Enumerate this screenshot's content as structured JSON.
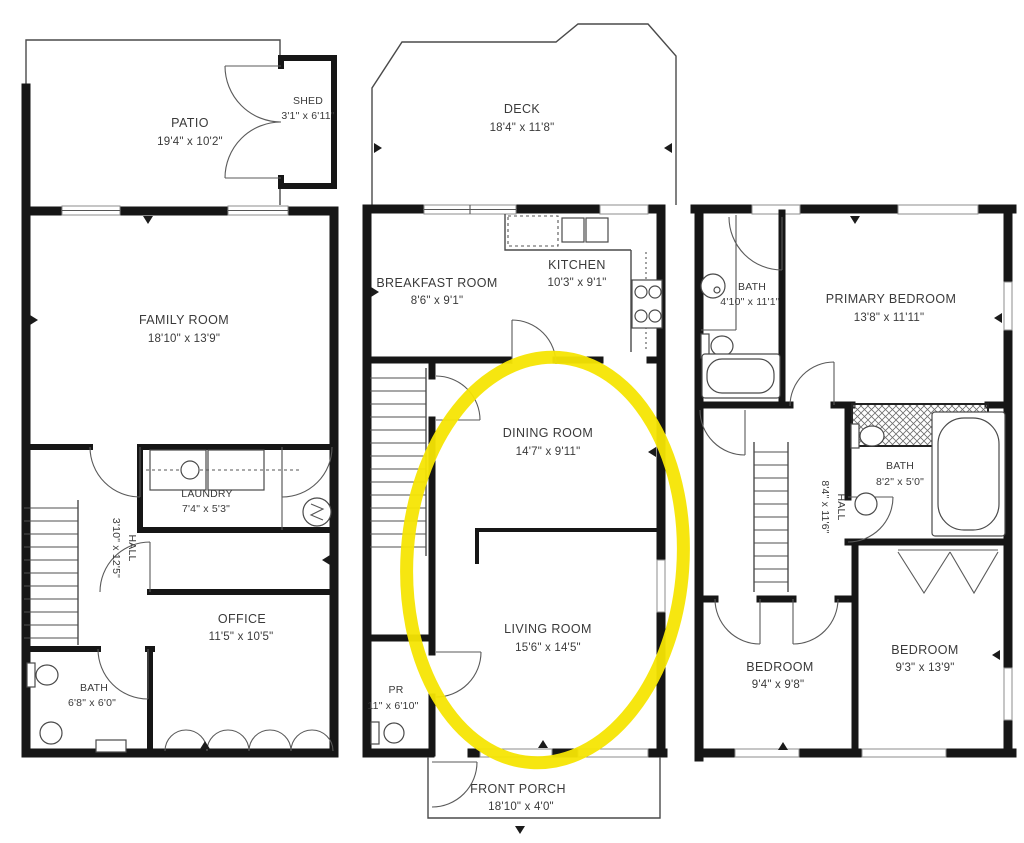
{
  "rooms": {
    "patio": {
      "name": "PATIO",
      "dims": "19'4\" x 10'2\""
    },
    "shed": {
      "name": "SHED",
      "dims": "3'1\" x 6'11\""
    },
    "family_room": {
      "name": "FAMILY ROOM",
      "dims": "18'10\" x 13'9\""
    },
    "laundry": {
      "name": "LAUNDRY",
      "dims": "7'4\" x 5'3\""
    },
    "hall_first": {
      "name": "HALL",
      "dims": "3'10\" x 12'5\""
    },
    "office": {
      "name": "OFFICE",
      "dims": "11'5\" x 10'5\""
    },
    "bath_first": {
      "name": "BATH",
      "dims": "6'8\" x 6'0\""
    },
    "deck": {
      "name": "DECK",
      "dims": "18'4\" x 11'8\""
    },
    "breakfast_room": {
      "name": "BREAKFAST ROOM",
      "dims": "8'6\" x 9'1\""
    },
    "kitchen": {
      "name": "KITCHEN",
      "dims": "10'3\" x 9'1\""
    },
    "dining_room": {
      "name": "DINING ROOM",
      "dims": "14'7\" x 9'11\""
    },
    "living_room": {
      "name": "LIVING ROOM",
      "dims": "15'6\" x 14'5\""
    },
    "powder_room": {
      "name": "PR",
      "dims": "11\" x 6'10\""
    },
    "front_porch": {
      "name": "FRONT PORCH",
      "dims": "18'10\" x 4'0\""
    },
    "bath_primary": {
      "name": "BATH",
      "dims": "4'10\" x 11'1\""
    },
    "primary_bedroom": {
      "name": "PRIMARY BEDROOM",
      "dims": "13'8\" x 11'11\""
    },
    "hall_second": {
      "name": "HALL",
      "dims": "8'4\" x 11'6\""
    },
    "bath_second": {
      "name": "BATH",
      "dims": "8'2\" x 5'0\""
    },
    "bedroom_a": {
      "name": "BEDROOM",
      "dims": "9'4\" x 9'8\""
    },
    "bedroom_b": {
      "name": "BEDROOM",
      "dims": "9'3\" x 13'9\""
    }
  },
  "annotation": {
    "highlight_color": "#f5e503",
    "shape": "ellipse",
    "circled_rooms": "DINING ROOM, LIVING ROOM"
  }
}
